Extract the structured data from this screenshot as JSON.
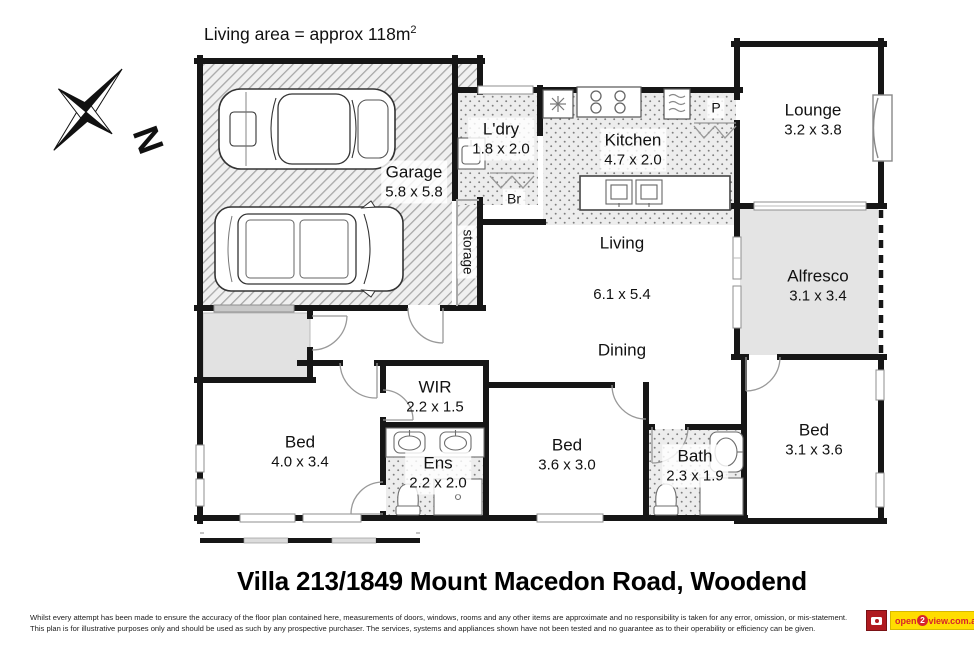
{
  "plan": {
    "area_note": {
      "text": "Living area = approx 118m",
      "sup": "2"
    },
    "compass": {
      "label": "N"
    },
    "rooms": {
      "garage": {
        "name": "Garage",
        "dims": "5.8 x 5.8"
      },
      "laundry": {
        "name": "L'dry",
        "dims": "1.8 x 2.0"
      },
      "broom": {
        "name": "Br"
      },
      "storage": {
        "name": "storage"
      },
      "kitchen": {
        "name": "Kitchen",
        "dims": "4.7 x 2.0"
      },
      "pantry": {
        "name": "P"
      },
      "lounge": {
        "name": "Lounge",
        "dims": "3.2 x 3.8"
      },
      "alfresco": {
        "name": "Alfresco",
        "dims": "3.1 x 3.4"
      },
      "living": {
        "name": "Living",
        "dims": "6.1 x 5.4"
      },
      "dining": {
        "name": "Dining"
      },
      "bed_main": {
        "name": "Bed",
        "dims": "4.0 x 3.4"
      },
      "wir": {
        "name": "WIR",
        "dims": "2.2 x 1.5"
      },
      "ensuite": {
        "name": "Ens",
        "dims": "2.2 x 2.0"
      },
      "bed_two": {
        "name": "Bed",
        "dims": "3.6 x 3.0"
      },
      "bath": {
        "name": "Bath",
        "dims": "2.3 x 1.9"
      },
      "bed_three": {
        "name": "Bed",
        "dims": "3.1 x 3.6"
      }
    }
  },
  "footer": {
    "title": "Villa 213/1849 Mount Macedon Road, Woodend",
    "disclaimer_line1": "Whilst every attempt has been made to ensure the accuracy of the floor plan contained here, measurements of doors, windows, rooms and any other items are approximate and no responsibility is taken for any error, omission, or mis-statement.",
    "disclaimer_line2": "This plan is for illustrative purposes only and should be used as such by any prospective purchaser. The services, systems and appliances shown have not been tested and no guarantee as to their operability or efficiency can be given.",
    "logo": {
      "prefix": "open",
      "two": "2",
      "suffix": "view.com.au"
    }
  },
  "colors": {
    "wall": "#161616",
    "hatch_line": "#a8a8a8",
    "outdoor_fill": "#e4e4e4",
    "logo_yellow": "#ffdd00",
    "logo_red": "#d6252b"
  }
}
